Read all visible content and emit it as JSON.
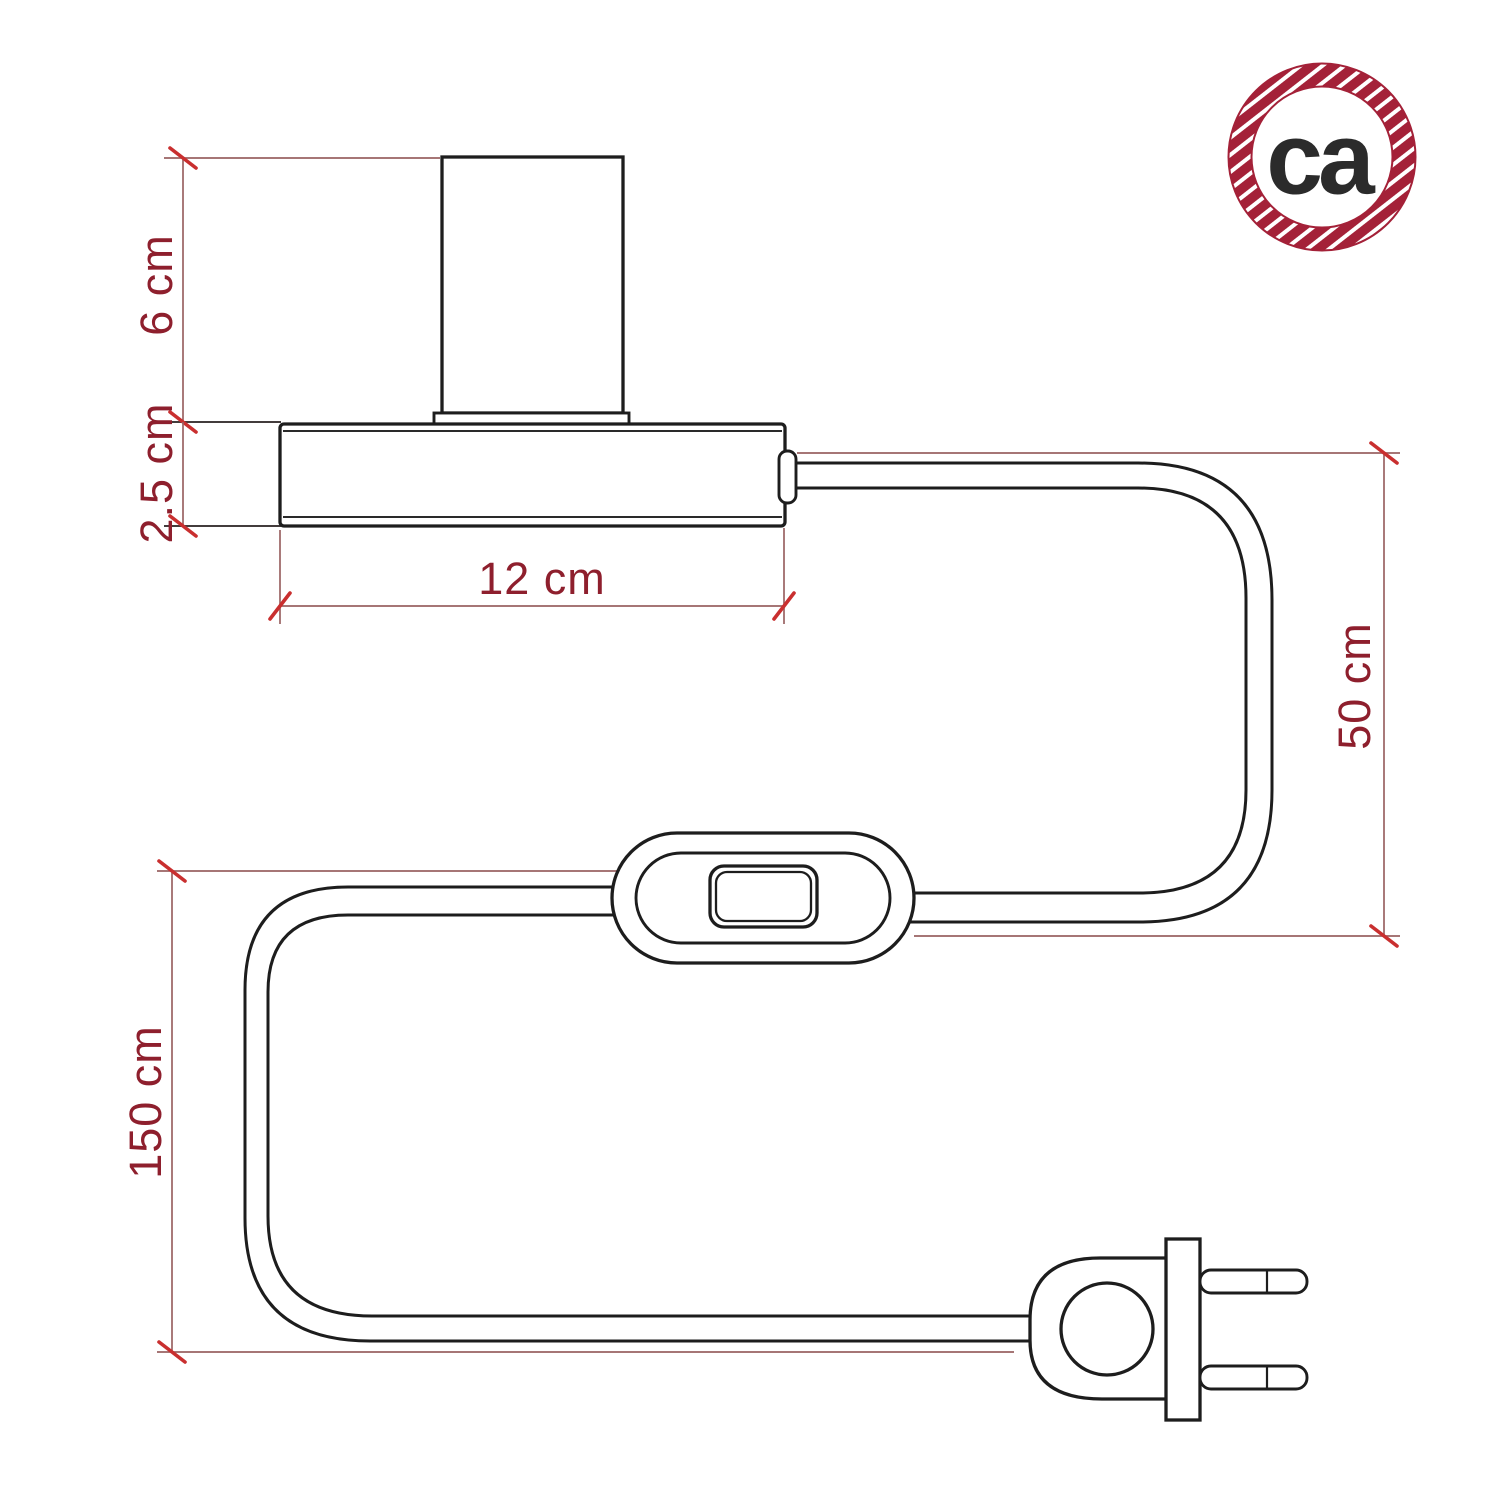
{
  "logo": {
    "text": "ca",
    "ring_color": "#a42138",
    "text_color": "#2b2b2b"
  },
  "dimensions": {
    "socket_height": {
      "label": "6 cm"
    },
    "base_height": {
      "label": "2.5 cm"
    },
    "base_width": {
      "label": "12 cm"
    },
    "lamp_to_switch": {
      "label": "50 cm"
    },
    "total_cable": {
      "label": "150 cm"
    }
  },
  "colors": {
    "background": "#ffffff",
    "outline": "#1d1d1d",
    "dimension_line": "#9a6363",
    "extension_line": "#433c3c",
    "tick": "#c92f2f",
    "label_text": "#8e1f2d",
    "logo_ring": "#a42138",
    "logo_text": "#2b2b2b"
  }
}
